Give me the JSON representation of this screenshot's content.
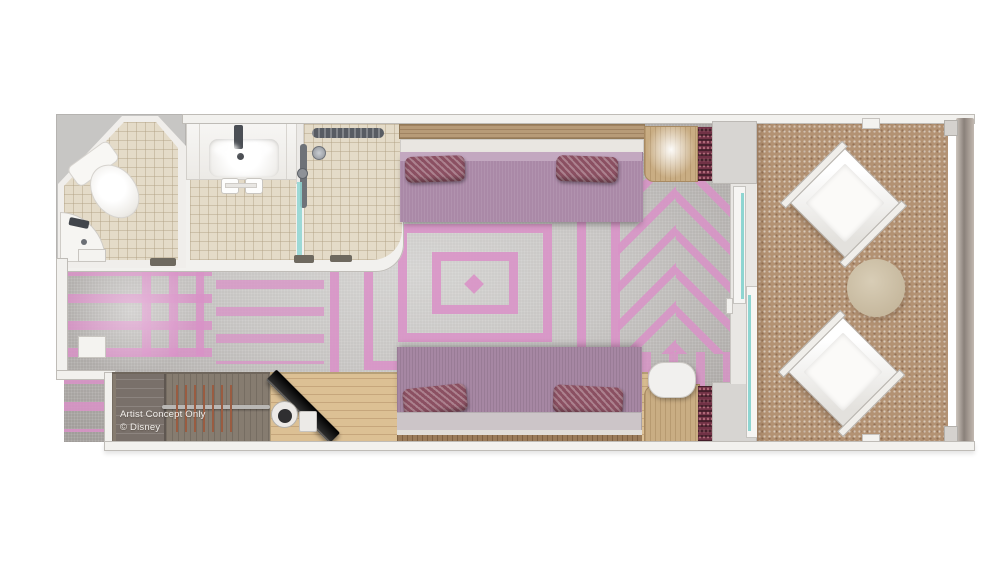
{
  "watermark": {
    "line1": "Artist Concept Only",
    "line2": "© Disney"
  },
  "plan": {
    "type": "cruise-stateroom-floorplan",
    "rooms": [
      "toilet-room",
      "vanity-room",
      "shower-room",
      "main-cabin",
      "closet",
      "desk-area",
      "verandah"
    ],
    "furniture": [
      "toilet",
      "corner-sink",
      "vanity-sink",
      "shower",
      "queen-bed",
      "sofa-bed",
      "pillows",
      "nightstand",
      "tv",
      "coffee-maker",
      "closet-rod",
      "hangers",
      "side-table",
      "desk-chair",
      "balcony-chairs",
      "balcony-table",
      "sliding-glass-door",
      "curtains",
      "railing"
    ]
  },
  "colors": {
    "wall": "#f2f1ee",
    "wall_line": "#bfbcb7",
    "void_gray": "#c7c6c4",
    "tile": "#e4dbc8",
    "carpet_light": "#d4d3d1",
    "carpet_dark": "#a19d9a",
    "pink": "#d992c7",
    "bed_purple": "#aa89a7",
    "bed_purple2": "#a687a3",
    "pillow": "#8b5062",
    "mattress": "#ccc5c8",
    "wood_shelf": "#b79b78",
    "wood_desk": "#dcc094",
    "wood_closet": "#867c70",
    "wood_table": "#c9ad83",
    "balcony_tan": "#b39273",
    "teal": "#8ed5d1",
    "curtain": "#713246",
    "watermark": "#f2efec"
  }
}
